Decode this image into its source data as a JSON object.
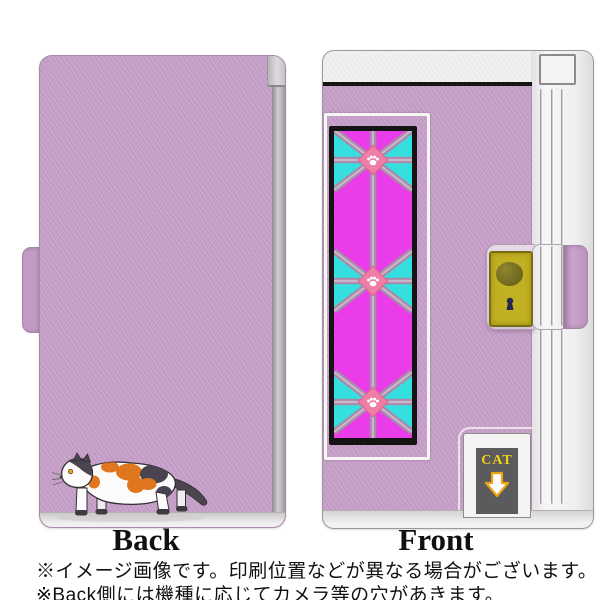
{
  "product_labels": {
    "back": "Back",
    "front": "Front"
  },
  "captions": {
    "line1": "※イメージ画像です。印刷位置などが異なる場合がございます。",
    "line2": "※Back側には機種に応じてカメラ等の穴があきます。"
  },
  "front_design": {
    "cat_door_text": "CAT",
    "arrow_icon": "down-arrow",
    "knob_icon": "door-knob",
    "keyhole_icon": "keyhole",
    "window_node_icon": "paw-print",
    "window_node_count": 3
  },
  "back_design": {
    "illustration": "calico-cat-walking"
  },
  "colors": {
    "case_purple": "#c6a0c8",
    "glass_magenta": "#ea3ce8",
    "glass_cyan": "#35dfe0",
    "lattice_mauve": "#a78ba8",
    "paw_diamond_pink": "#ee7ea6",
    "clasp_plate_yellow": "#c1b021",
    "door_panel_gray": "#5b5a5c",
    "cat_text_yellow": "#f2d512",
    "cat_orange": "#e0761d",
    "cat_dark_gray": "#4a4450"
  }
}
